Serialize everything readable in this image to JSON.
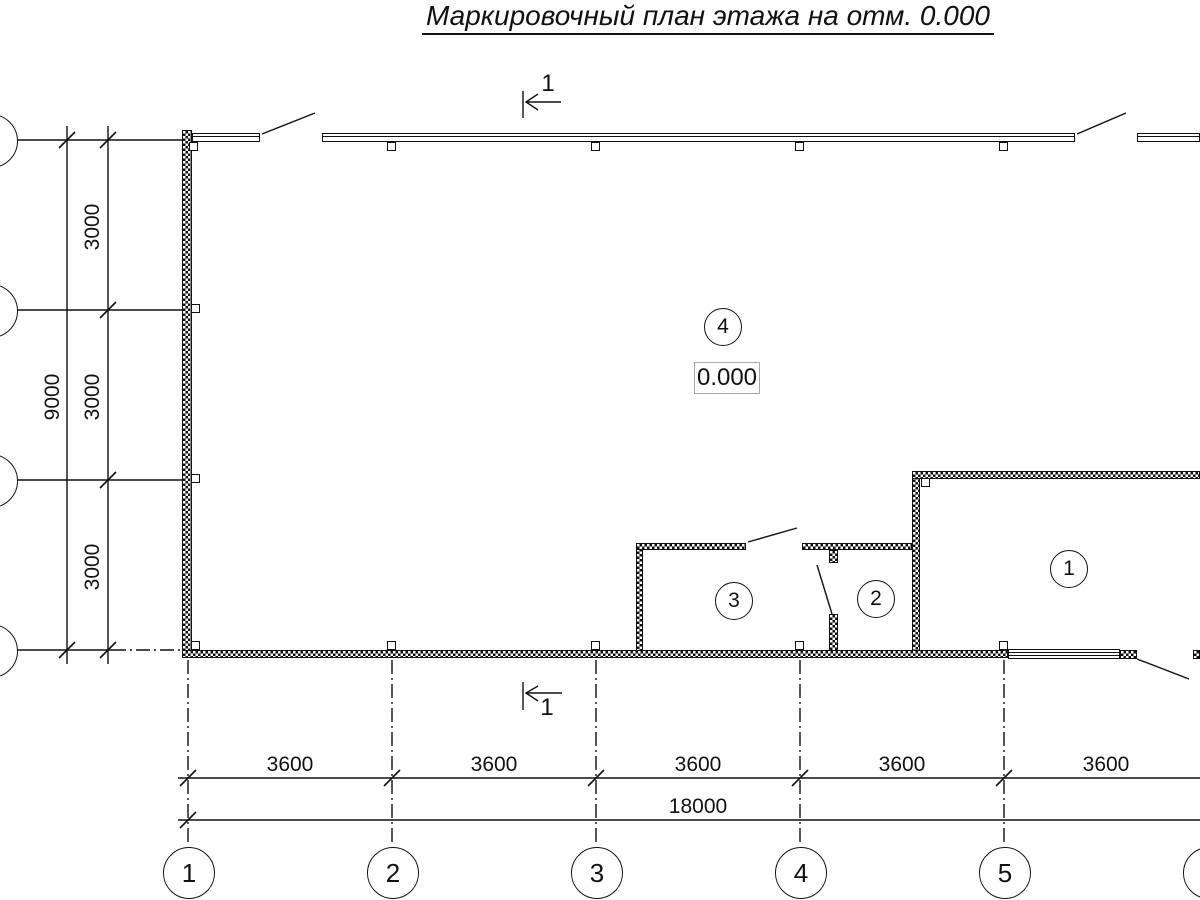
{
  "title": "Маркировочный план этажа на отм. 0.000",
  "elevation_mark": "0.000",
  "section_marks": {
    "top": "1",
    "bottom": "1"
  },
  "rooms": [
    {
      "number": "1"
    },
    {
      "number": "2"
    },
    {
      "number": "3"
    },
    {
      "number": "4"
    }
  ],
  "axes": {
    "bottom": [
      {
        "label": "1"
      },
      {
        "label": "2"
      },
      {
        "label": "3"
      },
      {
        "label": "4"
      },
      {
        "label": "5"
      },
      {
        "label": "6"
      }
    ],
    "left": [
      {
        "label": "Г"
      },
      {
        "label": "В"
      },
      {
        "label": "Б"
      },
      {
        "label": "А"
      }
    ]
  },
  "dimensions": {
    "horizontal": {
      "segments": [
        "3600",
        "3600",
        "3600",
        "3600",
        "3600"
      ],
      "total": "18000"
    },
    "vertical": {
      "segments": [
        "3000",
        "3000",
        "3000"
      ],
      "total": "9000"
    }
  },
  "colors": {
    "line": "#111111",
    "background": "#ffffff",
    "elevation_box_border": "#a8a8a8"
  }
}
